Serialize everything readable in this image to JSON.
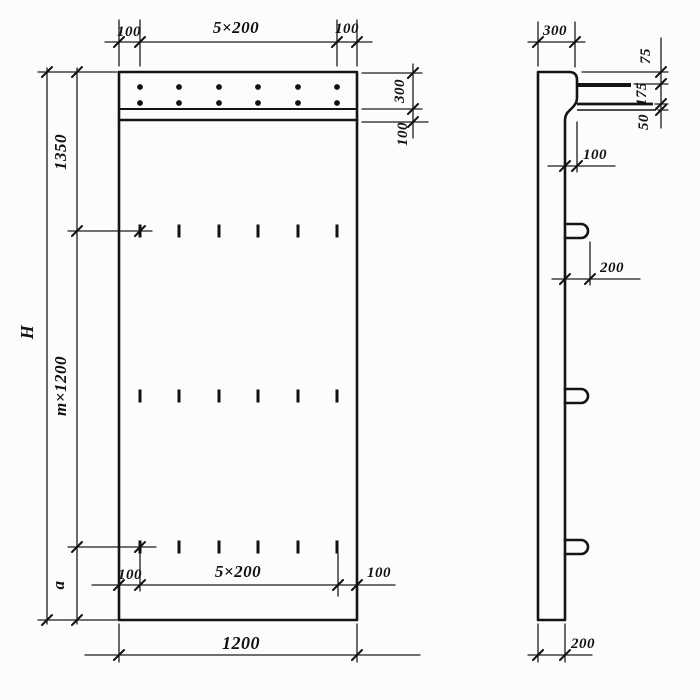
{
  "front_view": {
    "top": {
      "left": "100",
      "center": "5×200",
      "right": "100"
    },
    "right": {
      "band": "300",
      "strip": "100"
    },
    "left": {
      "overall": "H",
      "upper": "1350",
      "module": "m×1200",
      "lower": "a"
    },
    "bottom_inner": {
      "left": "100",
      "center": "5×200",
      "right": "100"
    },
    "bottom": {
      "width": "1200"
    }
  },
  "side_view": {
    "top": {
      "width": "300"
    },
    "chain": {
      "seg1": "75",
      "seg2": "175",
      "seg3": "50"
    },
    "step": {
      "offset": "100"
    },
    "hook": {
      "projection": "200"
    },
    "bottom": {
      "thickness": "200"
    }
  }
}
